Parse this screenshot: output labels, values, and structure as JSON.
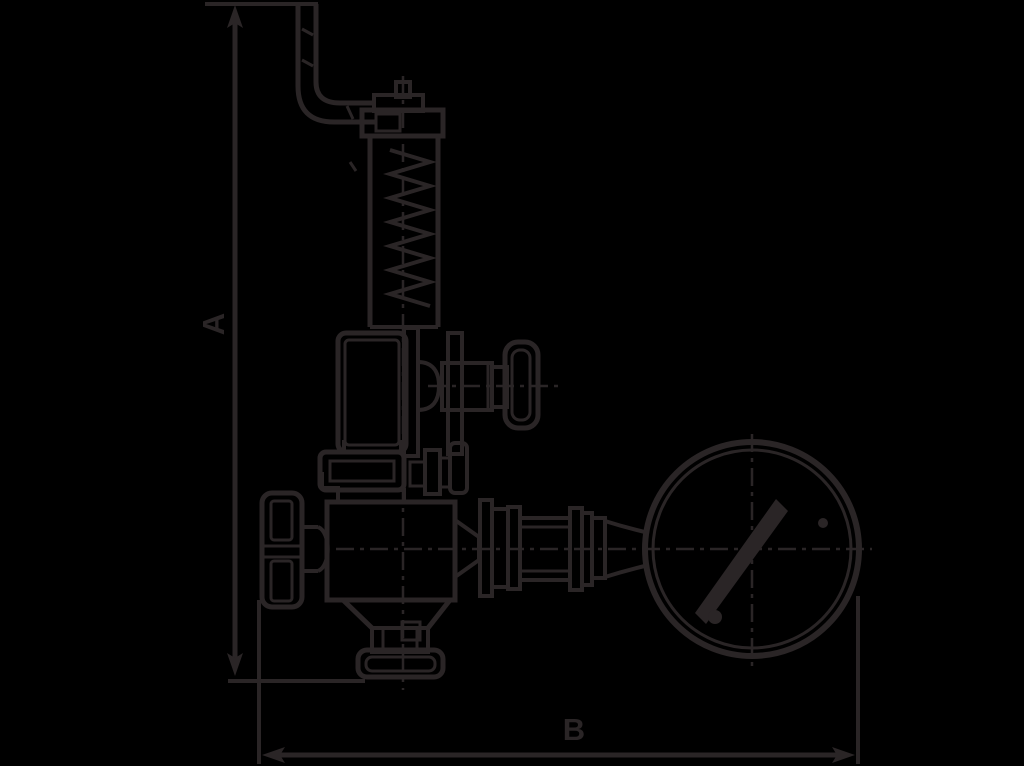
{
  "colors": {
    "background": "#000000",
    "ink": "#2a2526"
  },
  "labels": {
    "dimension_a": "A",
    "dimension_b": "B"
  },
  "figure": {
    "type": "technical-line-drawing",
    "parts": [
      "dimension-a-callout",
      "dimension-b-callout",
      "test-lever",
      "spindle-cap",
      "spring-housing",
      "spring-coil",
      "upper-body",
      "gauge-cock-knob",
      "body-flange",
      "handwheel",
      "lower-body",
      "outlet-union-nut",
      "gauge-piping",
      "pressure-gauge-dial",
      "gauge-needle",
      "centerlines"
    ]
  }
}
